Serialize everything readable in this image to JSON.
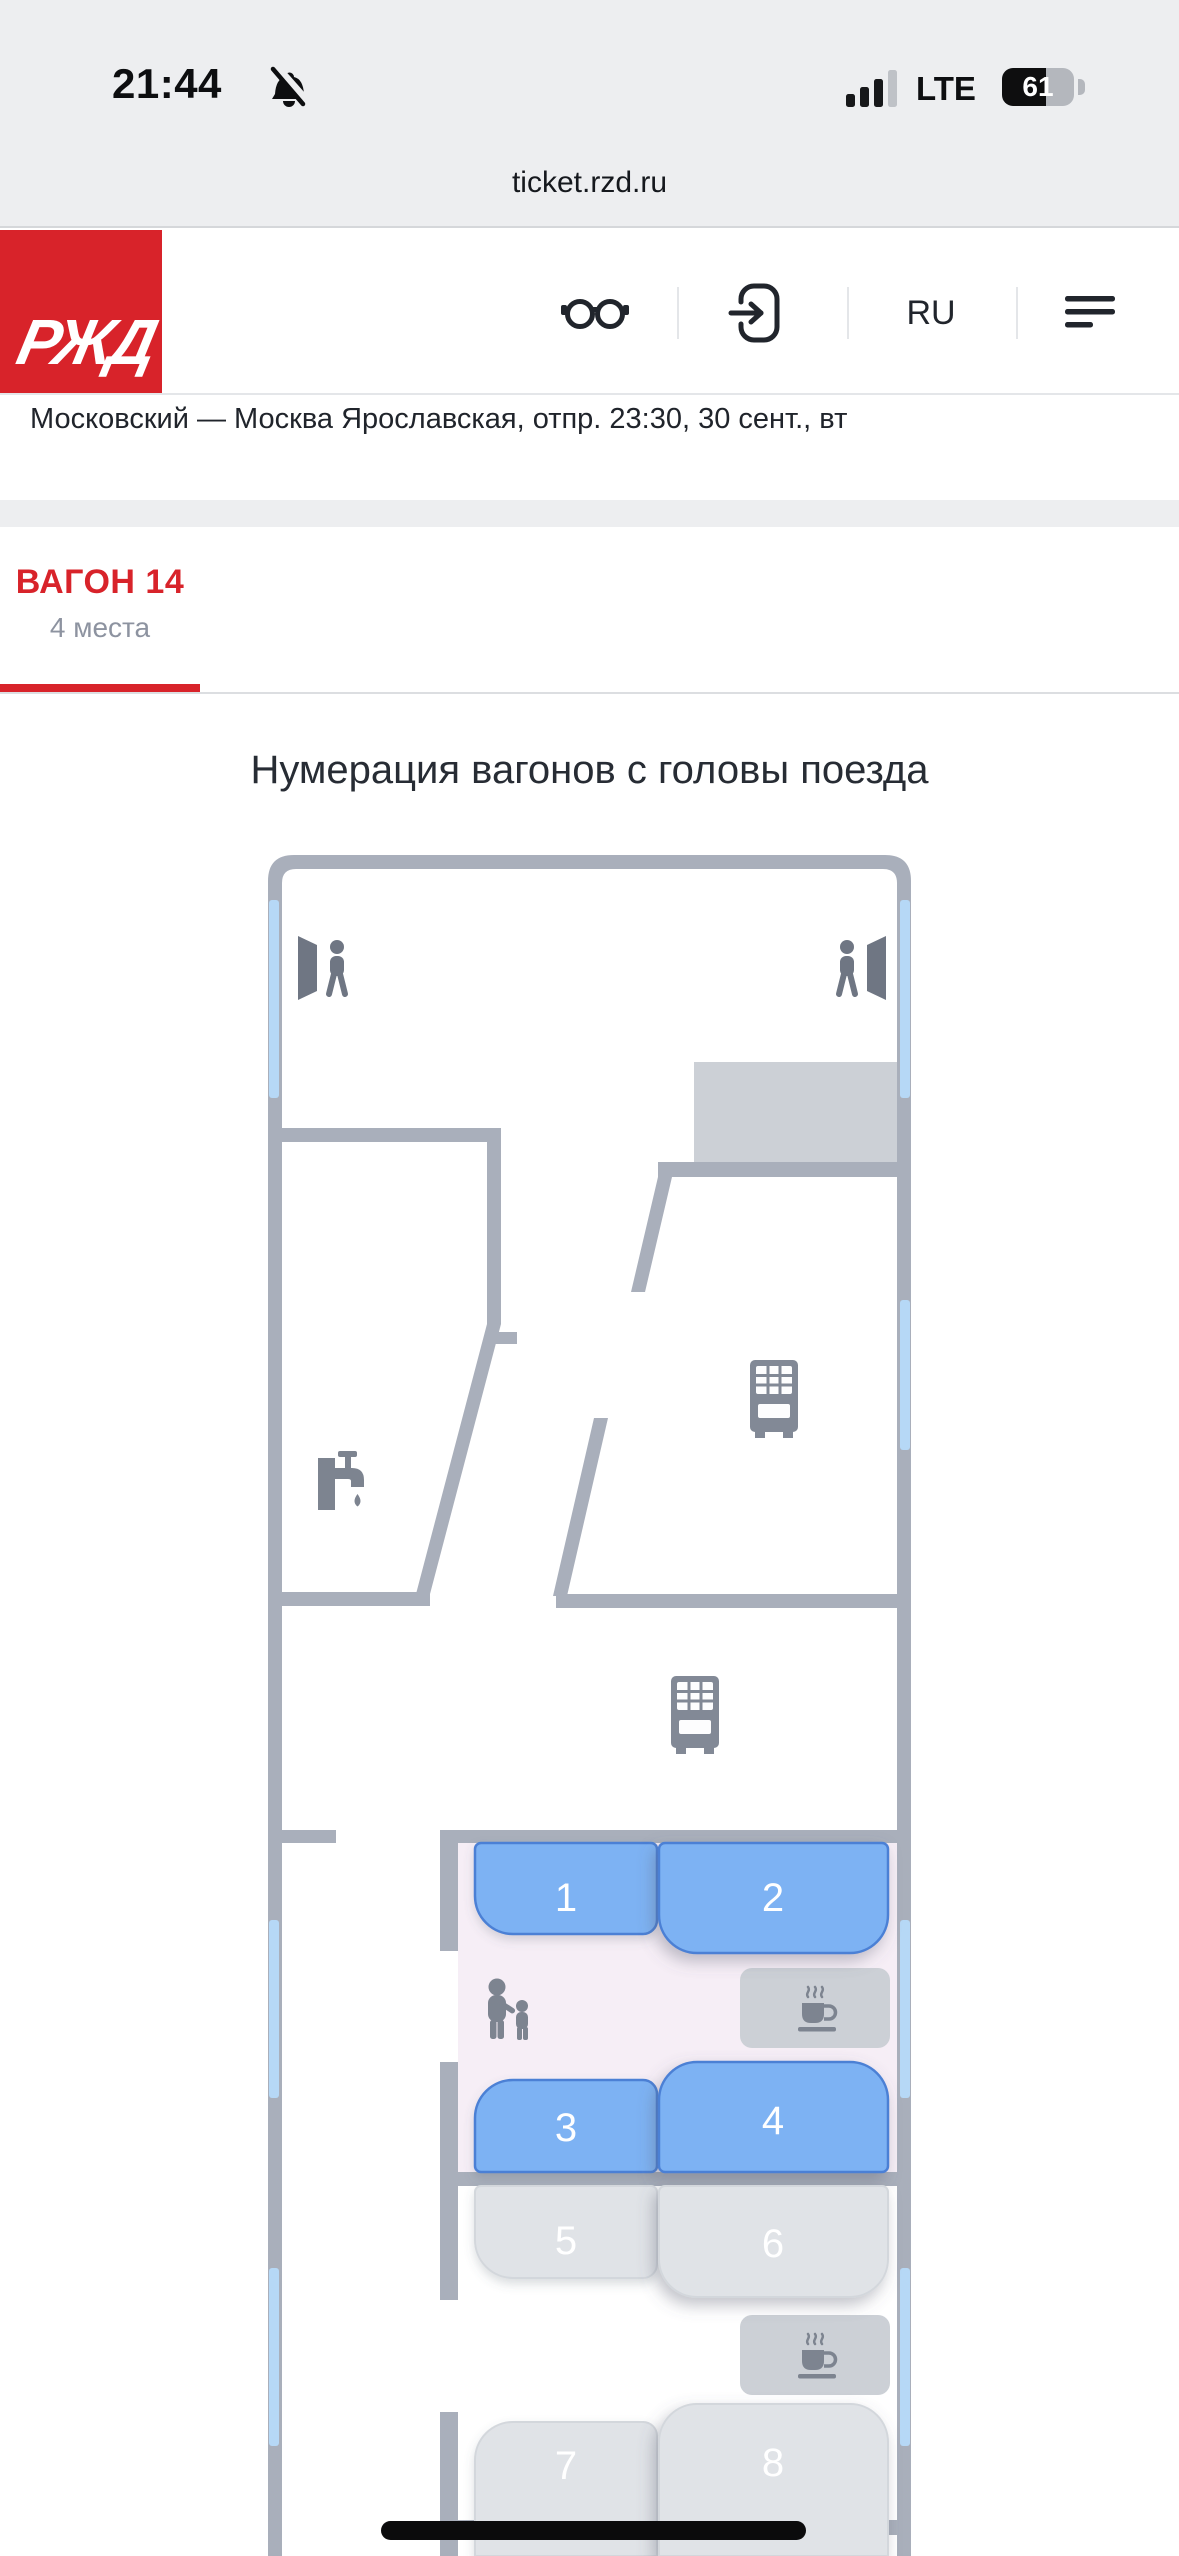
{
  "status_bar": {
    "time": "21:44",
    "network": "LTE",
    "battery": "61"
  },
  "browser": {
    "url": "ticket.rzd.ru"
  },
  "header": {
    "logo": "РЖД",
    "language": "RU"
  },
  "trip": {
    "summary": "Московский — Москва Ярославская, отпр. 23:30, 30 сент., вт"
  },
  "wagon_tab": {
    "title": "ВАГОН 14",
    "seats_free": "4 места"
  },
  "plan": {
    "caption": "Нумерация вагонов с головы поезда",
    "seats": [
      {
        "number": "1",
        "status": "available"
      },
      {
        "number": "2",
        "status": "available"
      },
      {
        "number": "3",
        "status": "available"
      },
      {
        "number": "4",
        "status": "available"
      },
      {
        "number": "5",
        "status": "unavailable"
      },
      {
        "number": "6",
        "status": "unavailable"
      },
      {
        "number": "7",
        "status": "unavailable"
      },
      {
        "number": "8",
        "status": "unavailable"
      }
    ]
  },
  "colors": {
    "brand_red": "#d8232a",
    "wall_gray": "#a9afbb",
    "window_blue": "#b6d8f6",
    "seat_available": "#7db2f3",
    "seat_unavailable": "#e0e3e7",
    "compartment_pink": "#f6eef6"
  }
}
